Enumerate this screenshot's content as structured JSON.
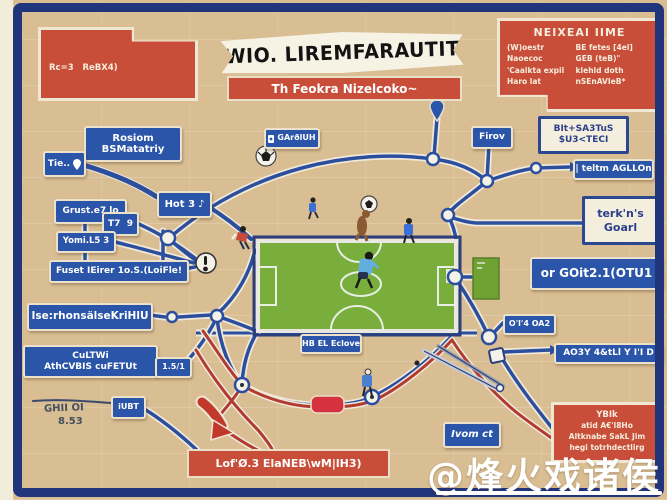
{
  "banner": {
    "title": "WIO. LIREMFARAUTIT",
    "subtitle": "Th Feokra Nizelcoko~"
  },
  "top_left_card": {
    "line1": "Rc=3   ReBX4)",
    "line2": "leatzo'  4C=",
    "line3": "[Rovbodlattlofdmg~oHaktfleJa",
    "line4": "b'4BL@7"
  },
  "top_right_card": {
    "title": "NEIXEAI IIME",
    "col1": [
      "(W)oestr",
      "Naoecoc",
      "'Caalkta expil",
      "Haro lat"
    ],
    "col2": [
      "BE fetes [4el]",
      "GEB (teB)\"",
      "klehld doth",
      "nSEnAVIeB*"
    ]
  },
  "nodes": {
    "rosiom": {
      "line1": "Rosiom",
      "line2": "BSMatatriy"
    },
    "tie": {
      "label": "Tie.."
    },
    "grust": {
      "label": "Grust.e7 lo"
    },
    "t79": {
      "label": "T7  9"
    },
    "hot3": {
      "label": "Hot 3",
      "icon": "♪"
    },
    "yomi": {
      "label": "Yomi.L5 3"
    },
    "fuset": {
      "label": "Fuset IEirer 1o.S.(LoiFle!"
    },
    "iserhon": {
      "label": "Ise:rhonsälseKriHlU"
    },
    "cultwi": {
      "line1": "CuLTWi",
      "line2": "AthCVBIS cuFETUt"
    },
    "ratio": {
      "label": "1.5/1"
    },
    "iubt": {
      "label": "iUBT"
    },
    "garolum": {
      "label": "GArðlUH"
    },
    "firov": {
      "label": "Firov"
    },
    "teltm": {
      "label": "| teltm AGLLOn"
    },
    "orgoit": {
      "label": "or GOit2.1(OTU1"
    },
    "ol4": {
      "label": "O'l'4 OA2"
    },
    "ao3y": {
      "label": "AO3Y 4&tLl Y I'I D"
    },
    "hbel": {
      "label": "HB EL Eclove"
    },
    "ivom": {
      "label": "Ivom ct"
    }
  },
  "callouts": {
    "bits": {
      "line1": "BIt+SA3TuS",
      "line2": "$U3<TECI"
    },
    "goarl": {
      "line1": "terk'n's",
      "line2": "Goarl"
    }
  },
  "labels": {
    "ghii": "GHII OI",
    "score": "8.53"
  },
  "bottom_banner": {
    "text": "Lof'Ø.3 ElaNEB\\wM|lH3)"
  },
  "bottom_right_card": {
    "lines": [
      "YBIk",
      "atid A€'l8Ho",
      "Altknabe SakL Jim",
      "hegi totrhdectlirg"
    ]
  },
  "watermark": {
    "handle": "@烽火戏诸侯"
  },
  "colors": {
    "background": "#d9bd93",
    "frame": "#20357c",
    "card_red": "#c94e3a",
    "node_blue": "#2b55a8",
    "field_green": "#79ae3c",
    "line_blue": "#2b4f9e",
    "line_red": "#b23a31",
    "cream": "#efe7d2"
  }
}
